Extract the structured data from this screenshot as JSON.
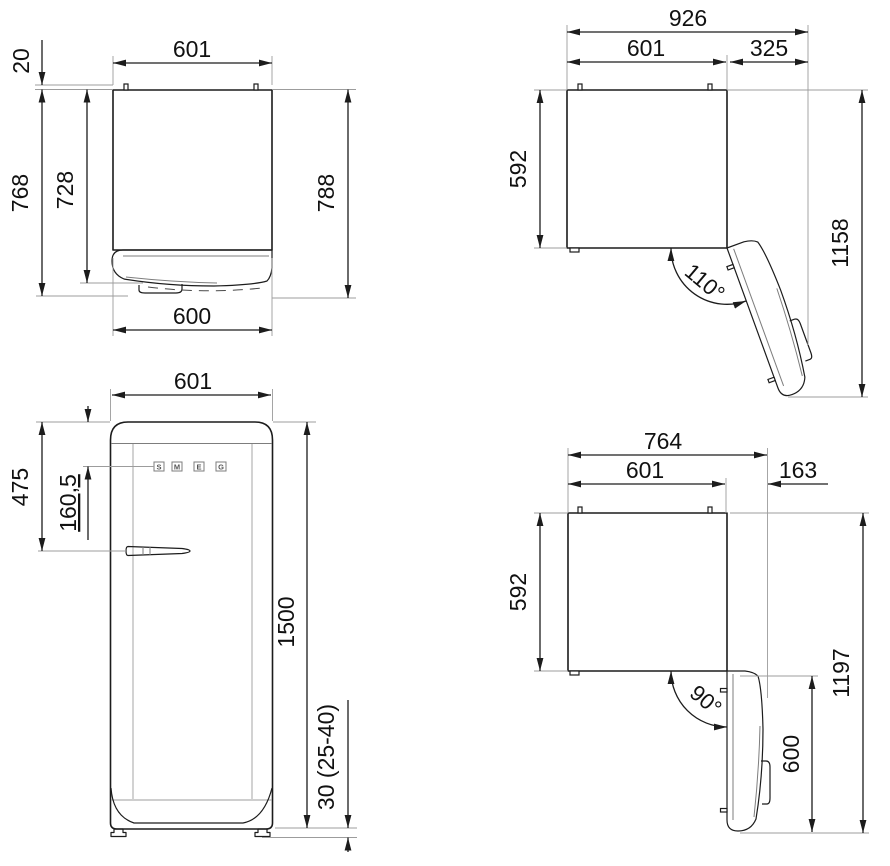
{
  "drawing_title": "refrigerator-dimension-drawing",
  "colors": {
    "line": "#1c1c1c",
    "extension": "#9c9c9c",
    "background": "#ffffff",
    "text": "#111111"
  },
  "views": {
    "top_closed": {
      "dim_width_top": "601",
      "dim_clearance_top": "20",
      "dim_depth_total": "768",
      "dim_depth_body": "728",
      "dim_depth_with_handle": "788",
      "dim_width_bottom": "600"
    },
    "top_open_110": {
      "dim_total_width": "926",
      "dim_body_width": "601",
      "dim_door_projection": "325",
      "dim_body_depth": "592",
      "dim_total_depth": "1158",
      "dim_angle": "110°"
    },
    "front": {
      "dim_width": "601",
      "dim_top_to_handle": "475",
      "dim_top_to_logo": "160,5",
      "dim_height": "1500",
      "dim_feet": "30 (25-40)",
      "logo_letters": [
        "S",
        "M",
        "E",
        "G"
      ]
    },
    "top_open_90": {
      "dim_total_width": "764",
      "dim_body_width": "601",
      "dim_door_projection": "163",
      "dim_body_depth": "592",
      "dim_total_depth": "1197",
      "dim_door_length": "600",
      "dim_angle": "90°"
    }
  }
}
